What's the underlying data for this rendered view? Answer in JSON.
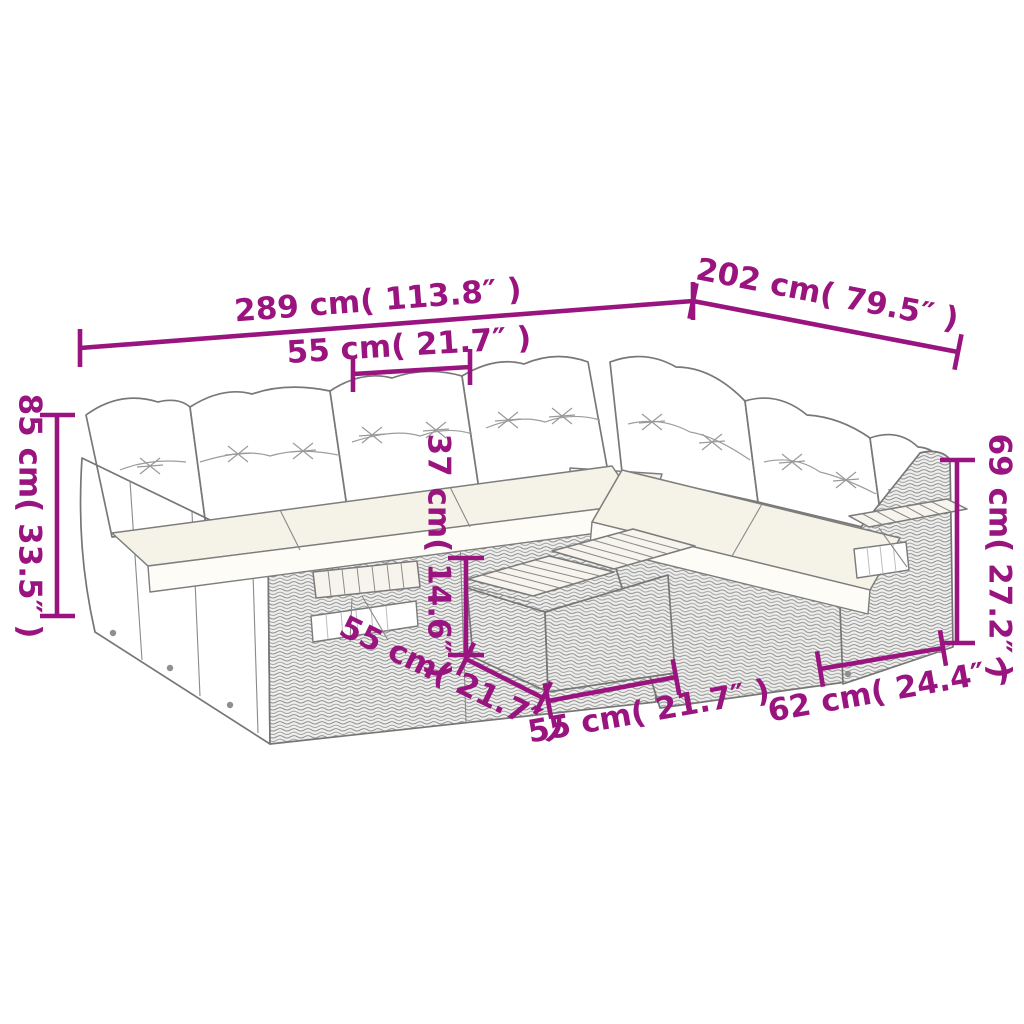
{
  "figure": {
    "kind": "product-dimension-diagram",
    "subject": "garden lounge sofa set line drawing with cushions and coffee table"
  },
  "palette": {
    "dimension_accent": "#9A1480",
    "line_art_grey": "#7a7a7a",
    "cushion_white": "#ffffff",
    "seat_cream": "#f5f2e7"
  },
  "dimensions": {
    "total_width": "289 cm( 113.8″ )",
    "total_depth": "202 cm( 79.5″ )",
    "seat_width": "55 cm( 21.7″ )",
    "overall_height": "85 cm( 33.5″ )",
    "table_height": "37 cm( 14.6″ )",
    "table_depth": "55 cm( 21.7″ )",
    "table_width": "55 cm( 21.7″ )",
    "module_depth": "62 cm( 24.4″ )",
    "arm_height": "69 cm( 27.2″ )"
  }
}
